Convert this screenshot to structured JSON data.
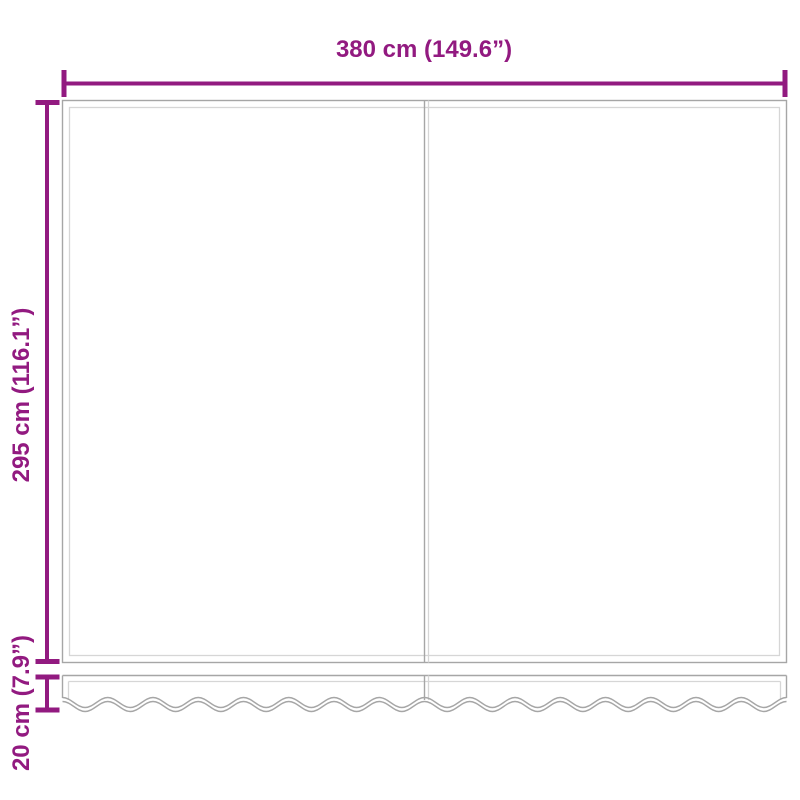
{
  "diagram": {
    "labels": {
      "width": "380 cm (149.6”)",
      "height": "295 cm (116.1”)",
      "valance": "20 cm (7.9”)"
    },
    "colors": {
      "dimension": "#921A80",
      "outline_dark": "#A6A6A6",
      "outline_light": "#D6D6D6",
      "background": "#FFFFFF"
    }
  }
}
